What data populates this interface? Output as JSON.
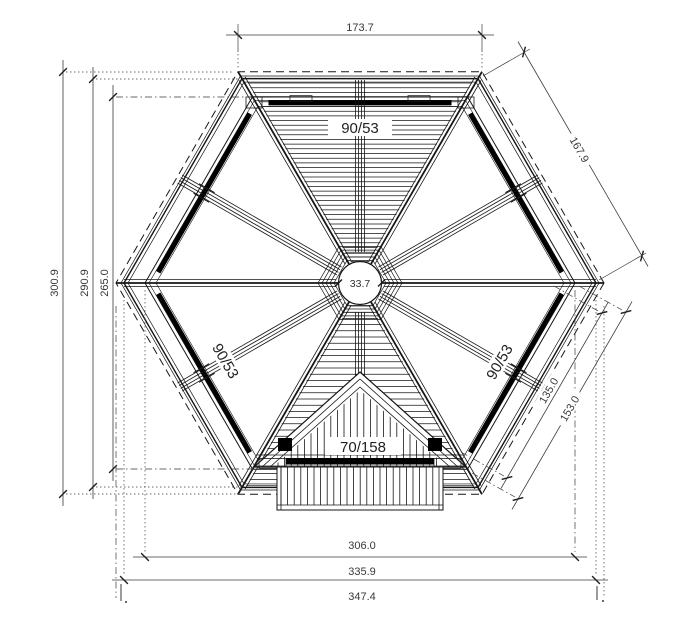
{
  "drawing": {
    "title": "hexagonal-roof-framing-plan",
    "dims": {
      "top_edge": "173.7",
      "left_outer": "300.9",
      "left_mid": "290.9",
      "left_inner": "265.0",
      "edge_upper_right": "167.9",
      "purlin_lower_right": "135.0",
      "edge_lower_right": "153.0",
      "bottom_inner": "306.0",
      "bottom_mid": "335.9",
      "bottom_outer": "347.4",
      "center_hub": "33.7"
    },
    "labels": {
      "purlin_top": "90/53",
      "purlin_lower_left": "90/53",
      "purlin_lower_right": "90/53",
      "gable_boards": "70/158"
    },
    "colors": {
      "line": "#161616",
      "dimension": "#3a3a3a",
      "label": "#222222",
      "background": "#ffffff"
    }
  }
}
